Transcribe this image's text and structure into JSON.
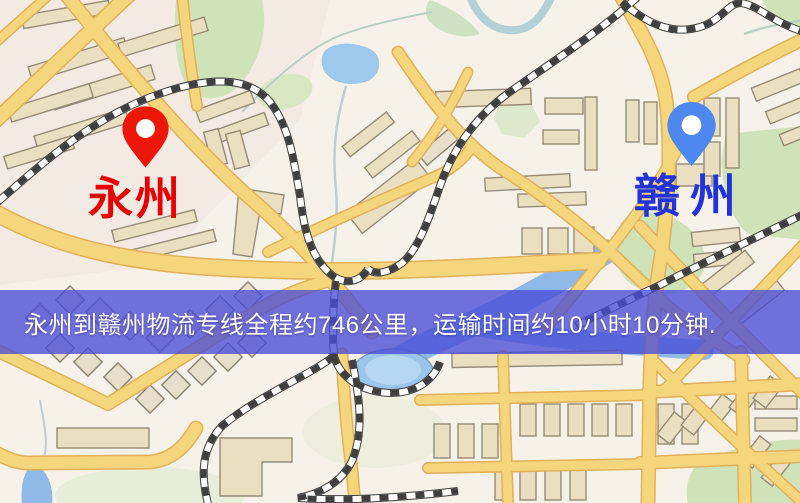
{
  "banner": {
    "text": "永州到赣州物流专线全程约746公里，运输时间约10小时10分钟.",
    "background_color": "#494cd6",
    "text_color": "#ffffff",
    "route": {
      "origin": "永州",
      "destination": "赣州",
      "distance_text": "约746公里",
      "duration_text": "约10小时10分钟"
    }
  },
  "markers": {
    "origin": {
      "label": "永州",
      "pin_color": "#ec1708",
      "label_color": "#e60202",
      "icon": "map-pin"
    },
    "destination": {
      "label": "赣州",
      "pin_color": "#4e88ef",
      "label_color": "#2233d9",
      "icon": "map-pin"
    }
  },
  "map": {
    "style": "cartoon-street-map",
    "colors": {
      "background": "#f7f2e9",
      "road": "#f5d67c",
      "road_casing": "#e2b158",
      "water": "#9ec8ec",
      "park": "#cfe2b8",
      "building": "#ebdfc2",
      "railway": "#3f3f3f"
    }
  }
}
